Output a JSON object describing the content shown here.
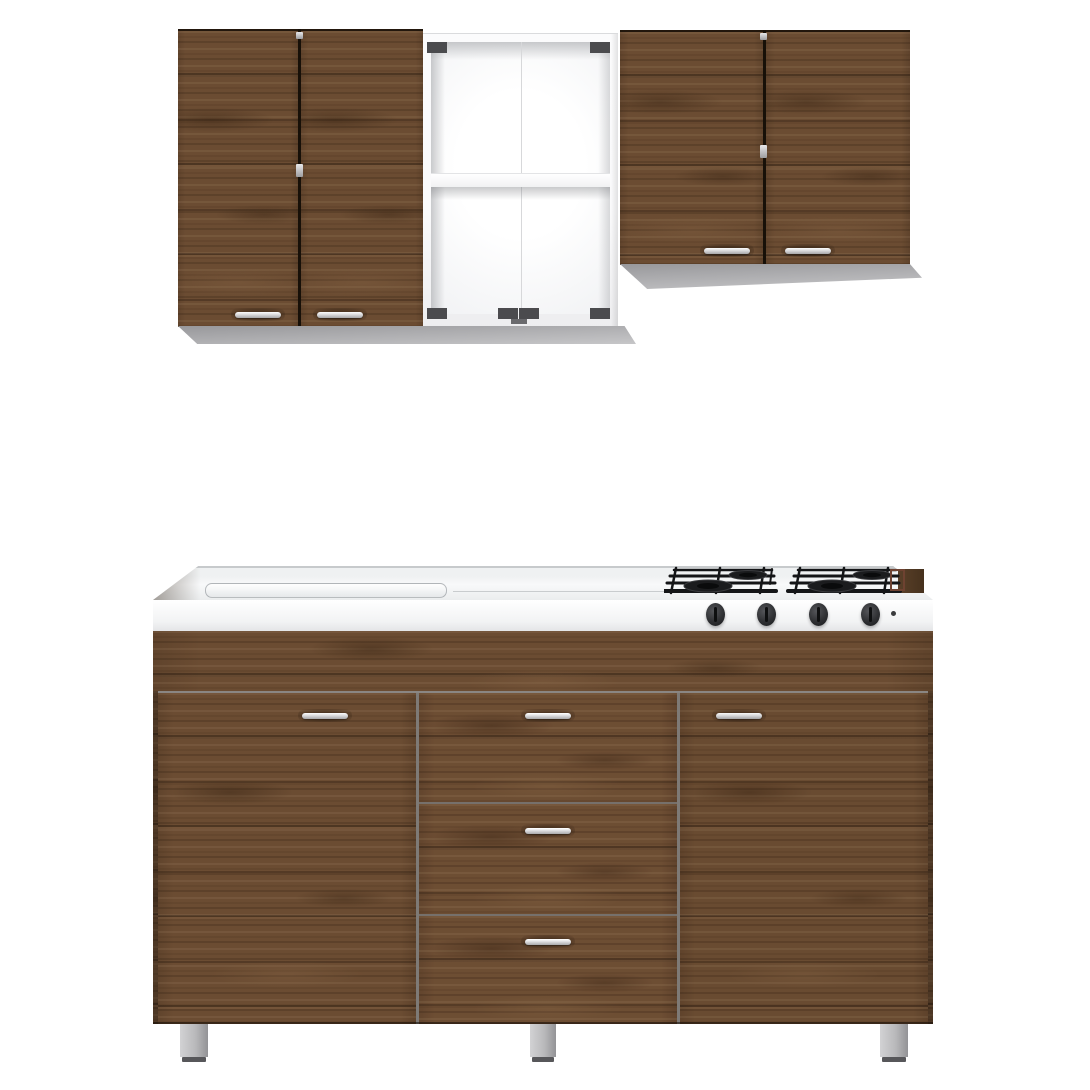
{
  "colors": {
    "bg": "#ffffff",
    "wood-base": "#6b4c32",
    "wood-dark": "#3f2a16",
    "gap-dark": "#171008",
    "carcass-white": "#fafafb",
    "interior-shade": "#e7e8ea",
    "underside-gray": "#98989b",
    "underside-gray-light": "#c6c6c8",
    "counter-white": "#f6f7f8",
    "counter-edge": "#c7cacc",
    "steel-light": "#fdfdfd",
    "steel-mid": "#d9d9db",
    "steel-dark": "#a6a6a8",
    "knob-dark": "#2f3033",
    "grate-black": "#141517",
    "grate-rust": "#6e4231",
    "leg-silver": "#b9b9bb",
    "leg-foot": "#57575a",
    "hinge-gray": "#4b4b4e"
  },
  "structure": {
    "wall_row": {
      "left_cabinet": {
        "doors": 2,
        "handles": 2,
        "hinge_marks": 2
      },
      "open_cabinet": {
        "shelves": 1,
        "hinge_plates": 6,
        "finish": "white"
      },
      "right_cabinet": {
        "doors": 2,
        "handles": 2,
        "hinge_marks": 2
      }
    },
    "base_cabinet": {
      "countertop": {
        "sink_outline": true
      },
      "cooktop": {
        "burners": 4,
        "knobs": 4,
        "ignition_dot": true
      },
      "doors": 2,
      "drawers": 3,
      "handles": 5,
      "legs": 3
    }
  }
}
